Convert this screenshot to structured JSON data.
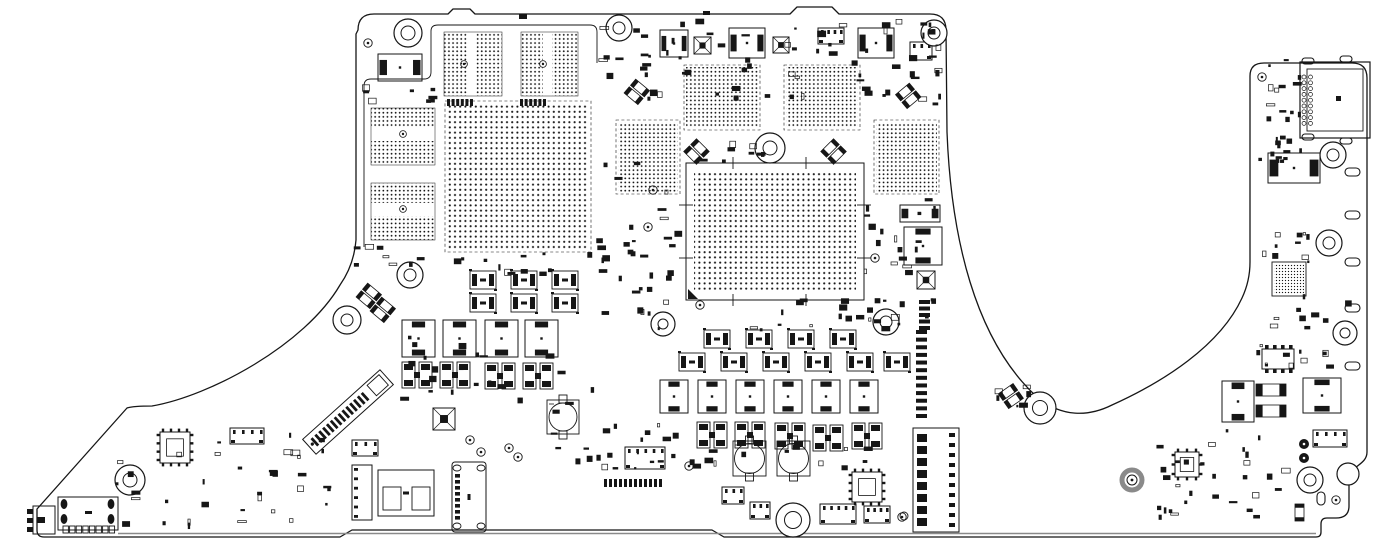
{
  "canvas": {
    "w": 1376,
    "h": 541,
    "bg": "#ffffff",
    "ink": "#161616",
    "gray": "#8a8a8a"
  },
  "board": {
    "outline": "M 358 30 Q 358 14 374 14 L 448 14 L 453 9 L 470 9 L 475 14 L 790 14 L 797 7 L 832 7 L 839 14 L 930 14 Q 946 14 946 30 L 947 132 C 951 235 974 340 1038 398 C 1062 417 1088 417 1112 405 C 1163 382 1220 346 1242 298 Q 1250 281 1250 262 L 1250 76 Q 1250 63 1264 63 L 1352 63 Q 1367 63 1367 78 L 1367 452 C 1367 461 1359 464 1354 469 Q 1349 474 1349 483 L 1349 506 Q 1349 518 1336 518 L 1327 518 Q 1321 518 1321 524 L 1321 532 Q 1321 537 1316 537 L 724 537 L 712 530 L 352 530 L 340 537 L 44 537 Q 37 537 37 530 L 37 509 L 127 408 Q 133 406 152 406 C 210 396 305 345 340 285 Q 354 265 356 240 L 356 34 Z",
    "fences": [
      "M 364 247 L 364 86 Q 364 79 371 79 L 424 79 Q 431 79 431 72 L 431 31 Q 431 25 438 25 L 590 25 Q 597 25 597 32 L 597 63"
    ],
    "inner_bottom_line": {
      "x1": 118,
      "y1": 533.5,
      "x2": 1316,
      "y2": 533.5
    },
    "edge_marks": [
      [
        519,
        14,
        8,
        5
      ],
      [
        703,
        11,
        7,
        4
      ]
    ]
  },
  "cpu": {
    "outline": [
      686,
      163,
      178,
      137
    ],
    "dots": [
      694,
      172,
      162,
      120
    ],
    "ticks": [
      [
        733,
        157,
        733,
        169
      ],
      [
        806,
        157,
        806,
        169
      ],
      [
        679,
        205,
        693,
        205
      ],
      [
        679,
        258,
        693,
        258
      ],
      [
        857,
        205,
        871,
        205
      ],
      [
        857,
        258,
        871,
        258
      ],
      [
        733,
        294,
        733,
        306
      ],
      [
        806,
        294,
        806,
        306
      ]
    ],
    "corner": [
      688,
      299,
      10
    ]
  },
  "bga_grids": [
    {
      "name": "gpu",
      "rect": [
        447,
        103,
        142,
        147
      ],
      "pitch": 5,
      "dash": true
    },
    {
      "name": "vram-top-left",
      "rect": [
        686,
        67,
        72,
        61
      ],
      "pitch": 4,
      "dash": true
    },
    {
      "name": "vram-top-right",
      "rect": [
        786,
        67,
        72,
        61
      ],
      "pitch": 4,
      "dash": true
    },
    {
      "name": "vram-left",
      "rect": [
        618,
        122,
        60,
        70
      ],
      "pitch": 4,
      "dash": true
    },
    {
      "name": "vram-right",
      "rect": [
        876,
        122,
        61,
        70
      ],
      "pitch": 4,
      "dash": true
    },
    {
      "name": "io-bga",
      "rect": [
        1274,
        264,
        30,
        30
      ],
      "pitch": 3,
      "outline": true
    }
  ],
  "banded_grids": [
    {
      "name": "mem-top-a",
      "border": [
        444,
        32,
        58,
        64
      ],
      "bands": [
        [
          444,
          32,
          23,
          64
        ],
        [
          476,
          32,
          26,
          64
        ]
      ],
      "circle": [
        464,
        64
      ]
    },
    {
      "name": "mem-top-b",
      "border": [
        521,
        32,
        57,
        64
      ],
      "bands": [
        [
          521,
          32,
          22,
          64
        ],
        [
          552,
          32,
          26,
          64
        ]
      ],
      "circle": [
        543,
        64
      ]
    },
    {
      "name": "mem-left-top",
      "border": [
        371,
        108,
        64,
        57
      ],
      "bands": [
        [
          371,
          108,
          64,
          20
        ],
        [
          371,
          141,
          64,
          24
        ]
      ],
      "circle": [
        403,
        134
      ]
    },
    {
      "name": "mem-left-bottom",
      "border": [
        371,
        183,
        64,
        57
      ],
      "bands": [
        [
          371,
          183,
          64,
          20
        ],
        [
          371,
          216,
          64,
          24
        ]
      ],
      "circle": [
        403,
        209
      ]
    }
  ],
  "components": [
    {
      "t": "ind",
      "x": 378,
      "y": 54,
      "w": 44,
      "h": 27,
      "o": "h"
    },
    {
      "t": "ind",
      "x": 660,
      "y": 30,
      "w": 28,
      "h": 27,
      "o": "h"
    },
    {
      "t": "ind",
      "x": 729,
      "y": 28,
      "w": 36,
      "h": 30,
      "o": "h"
    },
    {
      "t": "ind",
      "x": 858,
      "y": 28,
      "w": 36,
      "h": 30,
      "o": "h"
    },
    {
      "t": "qfnx",
      "x": 694,
      "y": 37,
      "w": 17,
      "h": 17
    },
    {
      "t": "qfnx",
      "x": 773,
      "y": 37,
      "w": 16,
      "h": 16
    },
    {
      "t": "ch",
      "x": 818,
      "y": 28,
      "w": 26,
      "h": 16,
      "n": 4
    },
    {
      "t": "ch",
      "x": 910,
      "y": 42,
      "w": 22,
      "h": 18,
      "n": 3
    },
    {
      "t": "pr",
      "x": 447,
      "y": 99,
      "w": 26,
      "h": 7,
      "n": 6,
      "o": "h"
    },
    {
      "t": "pr",
      "x": 520,
      "y": 99,
      "w": 26,
      "h": 7,
      "n": 6,
      "o": "h"
    },
    {
      "t": "cp",
      "x": 470,
      "y": 271
    },
    {
      "t": "cp",
      "x": 511,
      "y": 271
    },
    {
      "t": "cp",
      "x": 552,
      "y": 271
    },
    {
      "t": "cp",
      "x": 470,
      "y": 294
    },
    {
      "t": "cp",
      "x": 511,
      "y": 294
    },
    {
      "t": "cp",
      "x": 552,
      "y": 294
    },
    {
      "t": "ind",
      "x": 402,
      "y": 320,
      "w": 33,
      "h": 37,
      "o": "v"
    },
    {
      "t": "ind",
      "x": 443,
      "y": 320,
      "w": 33,
      "h": 37,
      "o": "v"
    },
    {
      "t": "ind",
      "x": 485,
      "y": 320,
      "w": 33,
      "h": 37,
      "o": "v"
    },
    {
      "t": "ind",
      "x": 525,
      "y": 320,
      "w": 33,
      "h": 37,
      "o": "v"
    },
    {
      "t": "mf",
      "x": 402,
      "y": 362
    },
    {
      "t": "mf",
      "x": 440,
      "y": 362
    },
    {
      "t": "mf",
      "x": 485,
      "y": 363
    },
    {
      "t": "mf",
      "x": 523,
      "y": 363
    },
    {
      "t": "cp",
      "x": 704,
      "y": 330
    },
    {
      "t": "cp",
      "x": 746,
      "y": 330
    },
    {
      "t": "cp",
      "x": 788,
      "y": 330
    },
    {
      "t": "cp",
      "x": 830,
      "y": 330
    },
    {
      "t": "cp",
      "x": 679,
      "y": 353
    },
    {
      "t": "cp",
      "x": 721,
      "y": 353
    },
    {
      "t": "cp",
      "x": 763,
      "y": 353
    },
    {
      "t": "cp",
      "x": 805,
      "y": 353
    },
    {
      "t": "cp",
      "x": 847,
      "y": 353
    },
    {
      "t": "cp",
      "x": 884,
      "y": 353
    },
    {
      "t": "ind",
      "x": 660,
      "y": 380,
      "w": 28,
      "h": 33,
      "o": "v"
    },
    {
      "t": "ind",
      "x": 698,
      "y": 380,
      "w": 28,
      "h": 33,
      "o": "v"
    },
    {
      "t": "ind",
      "x": 736,
      "y": 380,
      "w": 28,
      "h": 33,
      "o": "v"
    },
    {
      "t": "ind",
      "x": 774,
      "y": 380,
      "w": 28,
      "h": 33,
      "o": "v"
    },
    {
      "t": "ind",
      "x": 812,
      "y": 380,
      "w": 28,
      "h": 33,
      "o": "v"
    },
    {
      "t": "ind",
      "x": 850,
      "y": 380,
      "w": 28,
      "h": 33,
      "o": "v"
    },
    {
      "t": "mf",
      "x": 697,
      "y": 422
    },
    {
      "t": "mf",
      "x": 735,
      "y": 422
    },
    {
      "t": "mf",
      "x": 775,
      "y": 423
    },
    {
      "t": "mf",
      "x": 813,
      "y": 425
    },
    {
      "t": "mf",
      "x": 852,
      "y": 423
    },
    {
      "t": "rc",
      "x": 547,
      "y": 400,
      "w": 32,
      "h": 34,
      "r": 14
    },
    {
      "t": "rc",
      "x": 733,
      "y": 441,
      "w": 33,
      "h": 35,
      "r": 15
    },
    {
      "t": "rc",
      "x": 777,
      "y": 441,
      "w": 33,
      "h": 35,
      "r": 15
    },
    {
      "t": "ind",
      "x": 900,
      "y": 205,
      "w": 40,
      "h": 17,
      "o": "h"
    },
    {
      "t": "ind",
      "x": 904,
      "y": 227,
      "w": 38,
      "h": 38,
      "o": "v"
    },
    {
      "t": "qfnx",
      "x": 917,
      "y": 271,
      "w": 18,
      "h": 18
    },
    {
      "t": "pr",
      "x": 919,
      "y": 300,
      "w": 11,
      "h": 30,
      "n": 5,
      "o": "v"
    },
    {
      "t": "pr",
      "x": 916,
      "y": 330,
      "w": 11,
      "h": 88,
      "n": 12,
      "o": "v"
    },
    {
      "t": "batt",
      "x": 913,
      "y": 428,
      "w": 46,
      "h": 104
    },
    {
      "t": "ch",
      "x": 625,
      "y": 447,
      "w": 40,
      "h": 22,
      "n": 5
    },
    {
      "t": "pr",
      "x": 604,
      "y": 479,
      "w": 58,
      "h": 8,
      "n": 12,
      "o": "h"
    },
    {
      "t": "ch",
      "x": 722,
      "y": 487,
      "w": 22,
      "h": 17,
      "n": 3
    },
    {
      "t": "ch",
      "x": 750,
      "y": 502,
      "w": 20,
      "h": 17,
      "n": 3
    },
    {
      "t": "qfp",
      "x": 852,
      "y": 472,
      "w": 30,
      "h": 30
    },
    {
      "t": "ch",
      "x": 820,
      "y": 504,
      "w": 36,
      "h": 20,
      "n": 5
    },
    {
      "t": "ch",
      "x": 864,
      "y": 506,
      "w": 26,
      "h": 17,
      "n": 4
    },
    {
      "t": "m2",
      "x": 348,
      "y": 412,
      "a": -42
    },
    {
      "t": "qfnx",
      "x": 433,
      "y": 408,
      "w": 22,
      "h": 22
    },
    {
      "t": "vconn",
      "x": 452,
      "y": 462,
      "w": 34,
      "h": 70
    },
    {
      "t": "spk",
      "x": 378,
      "y": 470,
      "w": 56,
      "h": 46
    },
    {
      "t": "cv",
      "x": 352,
      "y": 465,
      "w": 20,
      "h": 55,
      "n": 6
    },
    {
      "t": "ch",
      "x": 352,
      "y": 440,
      "w": 26,
      "h": 16,
      "n": 3
    },
    {
      "t": "lbconn",
      "x": 33,
      "y": 506
    },
    {
      "t": "lbbig",
      "x": 58,
      "y": 497
    },
    {
      "t": "qfp",
      "x": 160,
      "y": 432,
      "w": 30,
      "h": 31
    },
    {
      "t": "ch",
      "x": 230,
      "y": 428,
      "w": 34,
      "h": 16,
      "n": 4
    },
    {
      "t": "hdmi",
      "x": 1300,
      "y": 62
    },
    {
      "t": "ind",
      "x": 1268,
      "y": 153,
      "w": 52,
      "h": 30,
      "o": "h"
    },
    {
      "t": "sop",
      "x": 1262,
      "y": 349,
      "w": 32,
      "h": 20,
      "n": 4
    },
    {
      "t": "ind",
      "x": 1222,
      "y": 381,
      "w": 32,
      "h": 41,
      "o": "v"
    },
    {
      "t": "c2",
      "x": 1256,
      "y": 384,
      "w": 30,
      "h": 12,
      "o": "h"
    },
    {
      "t": "c2",
      "x": 1256,
      "y": 405,
      "w": 30,
      "h": 12,
      "o": "h"
    },
    {
      "t": "ind",
      "x": 1303,
      "y": 378,
      "w": 38,
      "h": 35,
      "o": "v"
    },
    {
      "t": "ch",
      "x": 1313,
      "y": 430,
      "w": 34,
      "h": 17,
      "n": 4
    },
    {
      "t": "qfp",
      "x": 1175,
      "y": 452,
      "w": 24,
      "h": 25
    },
    {
      "t": "pad2",
      "x": 1304,
      "y": 444
    },
    {
      "t": "c2",
      "x": 1295,
      "y": 504,
      "w": 9,
      "h": 17,
      "o": "v"
    },
    {
      "t": "thickring",
      "x": 1132,
      "y": 480
    }
  ],
  "mount_holes": [
    [
      408,
      33,
      14,
      7
    ],
    [
      619,
      28,
      13,
      6
    ],
    [
      934,
      33,
      13,
      6
    ],
    [
      770,
      148,
      15,
      7
    ],
    [
      410,
      275,
      13,
      6
    ],
    [
      347,
      320,
      14,
      6
    ],
    [
      663,
      324,
      12,
      5
    ],
    [
      886,
      322,
      13,
      6
    ],
    [
      1040,
      408,
      16,
      7.5
    ],
    [
      130,
      480,
      15,
      7
    ],
    [
      793,
      520,
      17,
      8.5
    ],
    [
      1333,
      155,
      13,
      6
    ],
    [
      1329,
      243,
      13,
      6
    ],
    [
      1345,
      333,
      12,
      5
    ],
    [
      1310,
      480,
      13,
      6
    ],
    [
      1348,
      474,
      11,
      0
    ]
  ],
  "fiducials": [
    [
      368,
      43
    ],
    [
      470,
      440
    ],
    [
      481,
      452
    ],
    [
      509,
      448
    ],
    [
      518,
      457
    ],
    [
      902,
      517
    ],
    [
      653,
      190
    ],
    [
      648,
      227
    ],
    [
      700,
      305
    ],
    [
      875,
      258
    ],
    [
      1262,
      77
    ],
    [
      689,
      466
    ],
    [
      1336,
      500
    ]
  ],
  "edge_ovals": [
    [
      1345,
      168,
      15,
      8
    ],
    [
      1345,
      211,
      15,
      8
    ],
    [
      1345,
      258,
      15,
      8
    ],
    [
      1345,
      304,
      15,
      8
    ],
    [
      1345,
      362,
      15,
      8
    ],
    [
      1317,
      492,
      8,
      13
    ],
    [
      1302,
      58,
      12,
      6
    ],
    [
      1340,
      56,
      12,
      6
    ],
    [
      1302,
      134,
      12,
      6
    ],
    [
      1340,
      138,
      12,
      6
    ]
  ],
  "slants": [
    [
      640,
      88,
      40
    ],
    [
      905,
      92,
      -40
    ],
    [
      700,
      148,
      45
    ],
    [
      830,
      148,
      -45
    ],
    [
      372,
      292,
      40
    ],
    [
      386,
      306,
      40
    ],
    [
      1008,
      392,
      -35
    ]
  ],
  "clusters": [
    [
      592,
      18,
      348,
      86,
      55,
      1
    ],
    [
      362,
      84,
      76,
      20,
      8,
      2
    ],
    [
      592,
      158,
      92,
      170,
      30,
      3
    ],
    [
      864,
      196,
      76,
      132,
      26,
      4
    ],
    [
      438,
      250,
      160,
      26,
      12,
      5
    ],
    [
      388,
      332,
      210,
      84,
      22,
      6
    ],
    [
      598,
      420,
      116,
      52,
      12,
      7
    ],
    [
      652,
      444,
      256,
      30,
      14,
      8
    ],
    [
      1256,
      58,
      46,
      108,
      26,
      9
    ],
    [
      1262,
      228,
      58,
      36,
      10,
      10
    ],
    [
      1252,
      292,
      100,
      82,
      20,
      11
    ],
    [
      1152,
      428,
      150,
      92,
      30,
      12
    ],
    [
      112,
      424,
      220,
      106,
      36,
      13
    ],
    [
      545,
      430,
      72,
      48,
      8,
      14
    ],
    [
      636,
      298,
      286,
      34,
      18,
      15
    ],
    [
      688,
      138,
      84,
      26,
      8,
      16
    ],
    [
      993,
      378,
      40,
      30,
      6,
      17
    ],
    [
      338,
      244,
      100,
      24,
      8,
      18
    ],
    [
      905,
      18,
      38,
      88,
      10,
      19
    ],
    [
      640,
      52,
      26,
      48,
      6,
      20
    ]
  ]
}
